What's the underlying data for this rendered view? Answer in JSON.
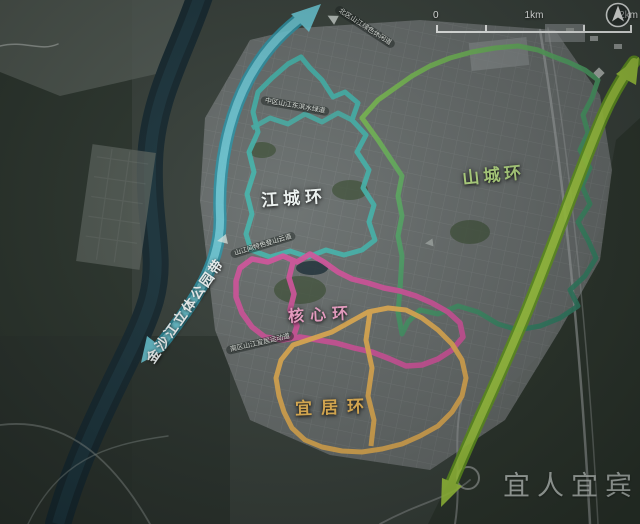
{
  "scale_bar": {
    "labels": [
      "0",
      "1km",
      "2km"
    ]
  },
  "compass": {
    "name": "north-arrow"
  },
  "watermark": {
    "text": "宜人宜宾"
  },
  "belts": {
    "river_belt": {
      "label": "金沙江立体公园带",
      "fill": "#6ed3e2",
      "edge": "#2d98ac",
      "label_color": "#f3f8f8"
    },
    "hill_belt": {
      "fill": "#a9d73f",
      "edge": "#679f1f"
    }
  },
  "rings": {
    "jiangcheng": {
      "label": "江城环",
      "stroke": "#45b7ae",
      "label_color": "#eef4f2"
    },
    "shancheng": {
      "label": "山城环",
      "stroke_start": "#8ac74a",
      "stroke_end": "#2e7d66",
      "label_color": "#b7dd84"
    },
    "hexin": {
      "label": "核心环",
      "stroke": "#d6549e",
      "label_color": "#f2a3c9"
    },
    "yiju": {
      "label": "宜居环",
      "stroke": "#e9b253",
      "label_color": "#f1bc57"
    }
  },
  "route_labels": [
    {
      "id": "north",
      "text": "北区山江绿色休闲道"
    },
    {
      "id": "middle",
      "text": "中区山江东滨水绿道"
    },
    {
      "id": "hill",
      "text": "山江间特色登山云道"
    },
    {
      "id": "south",
      "text": "南区山江宜居运动道"
    }
  ]
}
